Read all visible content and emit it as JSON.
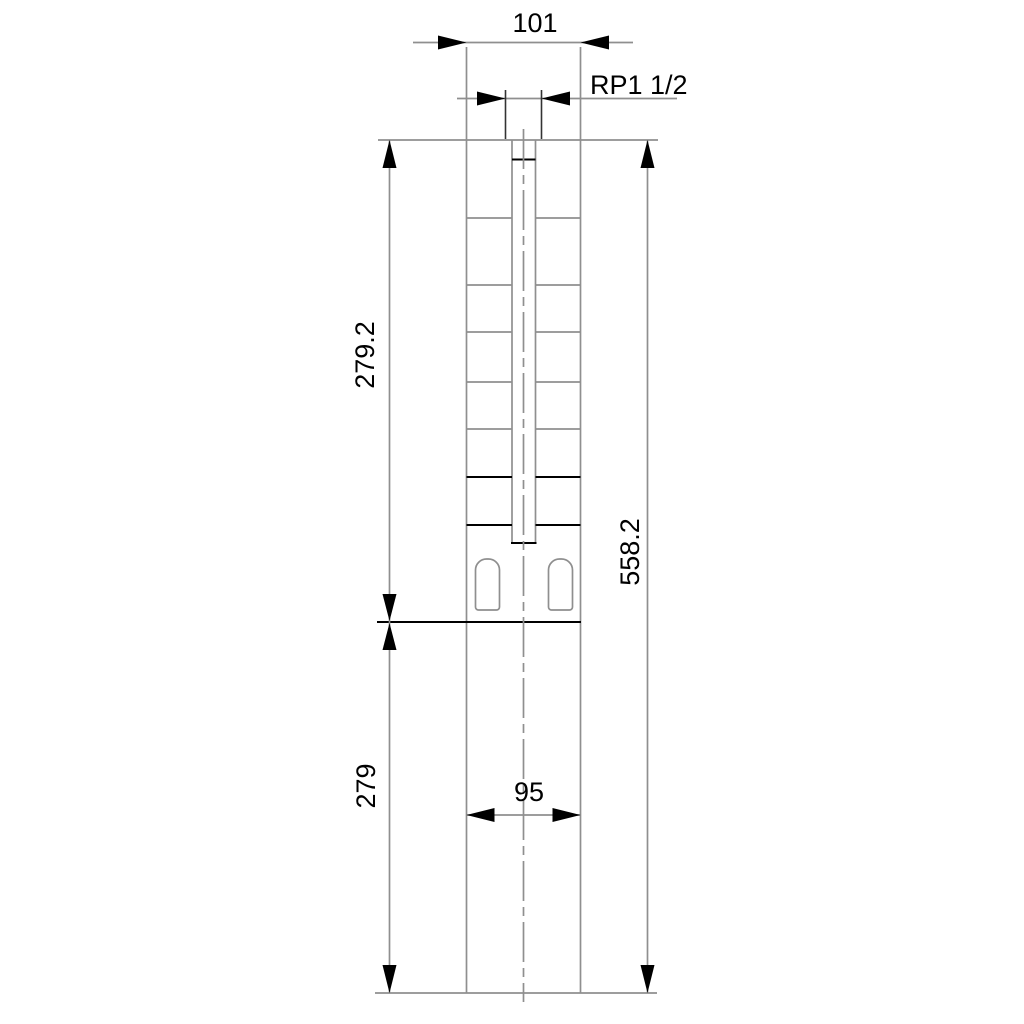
{
  "drawing": {
    "labels": {
      "top_width": "101",
      "thread_size": "RP1 1/2",
      "pump_section_height": "279.2",
      "total_height": "558.2",
      "motor_section_height": "279",
      "motor_width": "95"
    },
    "colors": {
      "outline_gray": "#8f8f8f",
      "emphasis_black": "#000000",
      "background": "#ffffff"
    }
  }
}
